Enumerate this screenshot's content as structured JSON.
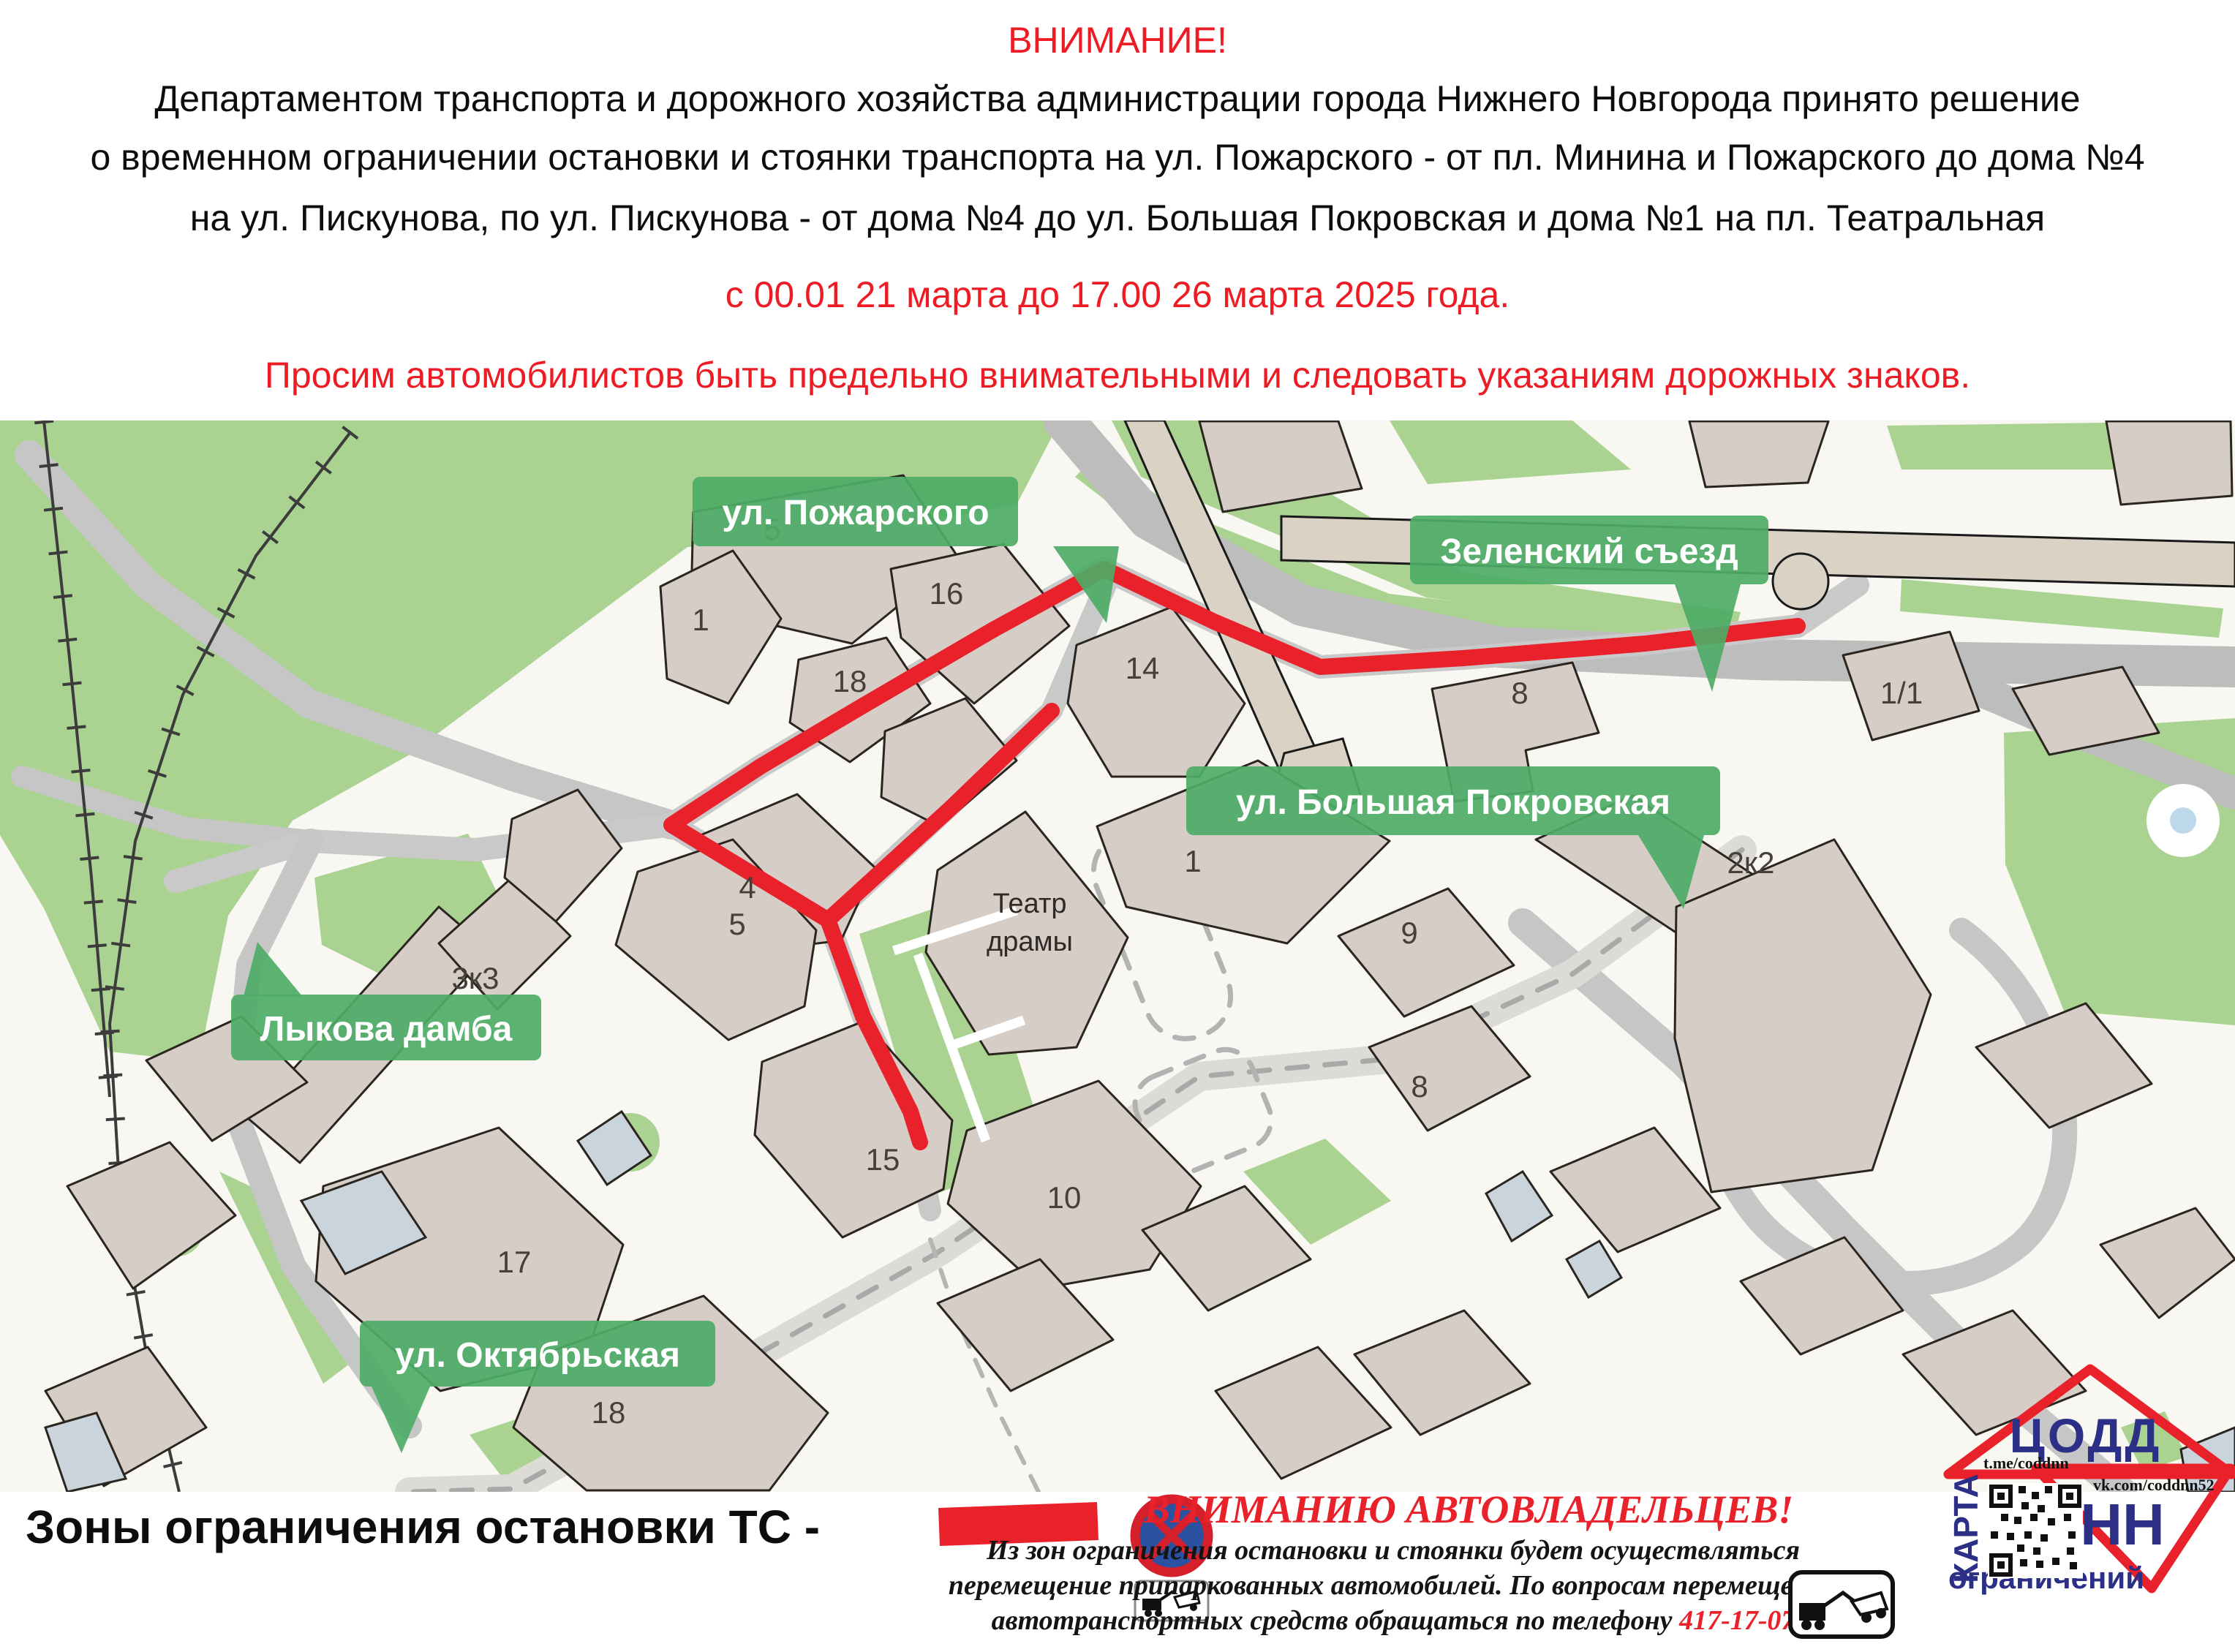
{
  "header": {
    "line1": "ВНИМАНИЕ!",
    "line2": "Департаментом транспорта и дорожного хозяйства администрации города Нижнего Новгорода принято решение",
    "line3": "о временном ограничении остановки и стоянки транспорта на ул. Пожарского - от пл. Минина и Пожарского до дома №4",
    "line4": "на ул. Пискунова, по ул. Пискунова - от дома №4 до ул. Большая Покровская и дома №1 на пл. Театральная",
    "line5": "с 00.01 21 марта до 17.00 26 марта 2025 года.",
    "line6": "Просим автомобилистов быть предельно внимательными и следовать указаниям дорожных знаков."
  },
  "map": {
    "street_labels": {
      "kremlin": "Нижегородский Кремль",
      "pozharskogo": "ул. Пожарского",
      "zelensky": "Зеленский съезд",
      "pokrovskaya": "ул. Большая Покровская",
      "lykova": "Лыкова дамба",
      "oktyabrskaya": "ул. Октябрьская"
    },
    "buildings": {
      "b5": "5",
      "b1": "1",
      "b16": "16",
      "b18": "18",
      "b14": "14",
      "b8a": "8",
      "b11": "1/1",
      "b4": "4",
      "b1b": "1",
      "b9": "9",
      "b2k2": "2к2",
      "b5b": "5",
      "b3k3": "3к3",
      "b8b": "8",
      "b15": "15",
      "b10": "10",
      "b17": "17",
      "b18b": "18"
    },
    "theater": {
      "line1": "Театр",
      "line2": "драмы"
    }
  },
  "legend": {
    "zones_label": "Зоны ограничения остановки ТС -"
  },
  "notice": {
    "title": "ВНИМАНИЮ АВТОВЛАДЕЛЬЦЕВ!",
    "line1": "Из зон ограничения остановки и стоянки будет осуществляться",
    "line2": "перемещение припаркованных автомобилей. По вопросам перемещения",
    "line3_prefix": "автотранспортных средств обращаться по телефону ",
    "phone": "417-17-07"
  },
  "logo": {
    "org": "ЦОДД",
    "city": "НН",
    "map_word": "КАРТА",
    "restrictions_word": "ограничений",
    "telegram": "t.me/coddnn",
    "vk": "vk.com/coddnn52"
  },
  "colors": {
    "accent_red": "#e8212a",
    "label_green": "#4dab66",
    "map_green": "#aad391",
    "building_fill": "#d6cdc7",
    "building_blue": "#c9d4dd",
    "road_gray": "#c6c6c6",
    "sign_blue": "#2a52a0",
    "logo_blue": "#2b2f86"
  }
}
